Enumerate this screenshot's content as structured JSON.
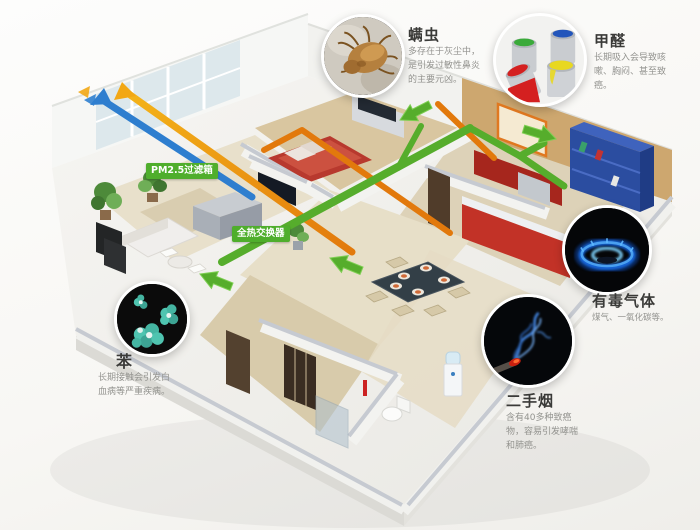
{
  "infographic": {
    "duct_labels": {
      "pm25_filter": "PM2.5过滤箱",
      "heat_exchanger": "全热交换器"
    },
    "callouts": {
      "mite": {
        "title": "螨虫",
        "desc": "多存在于灰尘中，是引发过敏性鼻炎的主要元凶。",
        "icon": "dust-mite-photo"
      },
      "formaldehyde": {
        "title": "甲醛",
        "desc": "长期吸入会导致咳嗽、胸闷、甚至致癌。",
        "icon": "paint-cans-photo"
      },
      "benzene": {
        "title": "苯",
        "desc": "长期接触会引发白血病等严重疾病。",
        "icon": "benzene-molecule-photo"
      },
      "toxic_gas": {
        "title": "有毒气体",
        "desc": "煤气、一氧化碳等。",
        "icon": "gas-flame-photo"
      },
      "secondhand_smoke": {
        "title": "二手烟",
        "desc": "含有40多种致癌物，容易引发哮喘和肺癌。",
        "icon": "cigarette-smoke-photo"
      }
    },
    "colors": {
      "supply_green": "#56ad2c",
      "exhaust_orange": "#e2790c",
      "fresh_blue": "#2e7ecf",
      "label_green": "#4fae2c"
    }
  }
}
